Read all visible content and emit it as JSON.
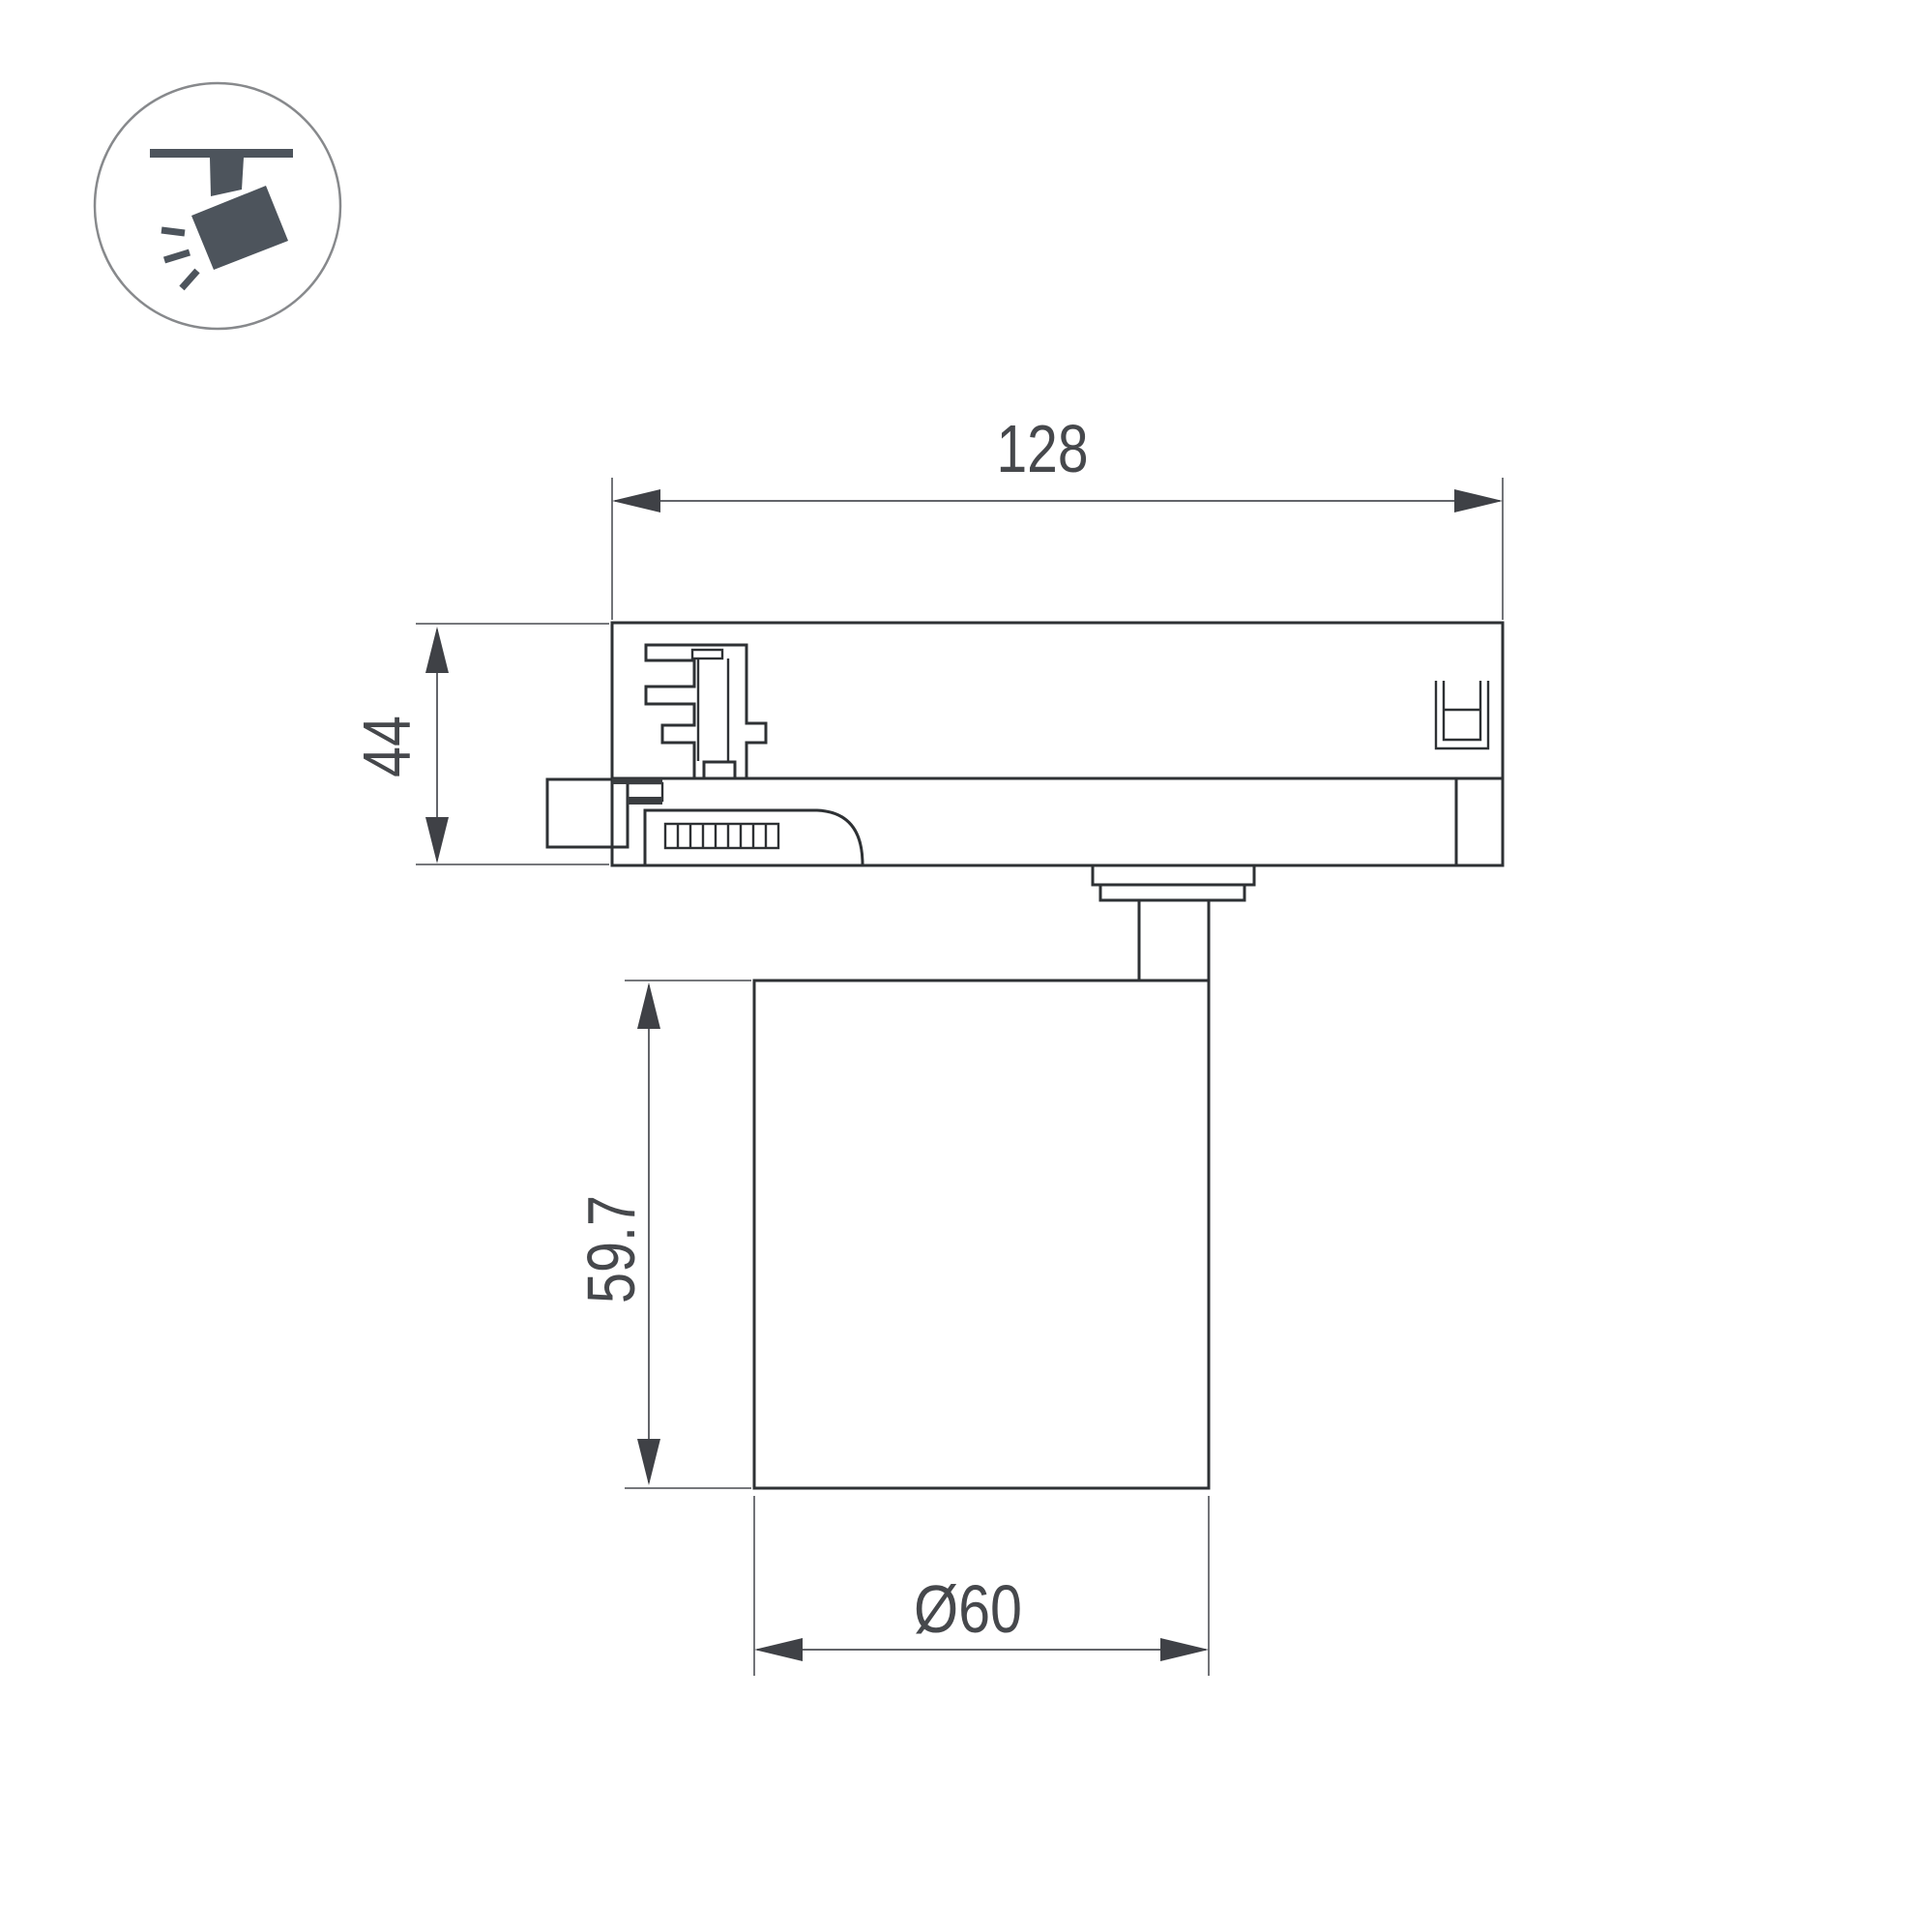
{
  "drawing": {
    "title": "Track spotlight dimensional drawing",
    "icon": "ceiling-track-spotlight-icon"
  },
  "dims": {
    "top_width": {
      "label": "128",
      "value": 128
    },
    "adapter_height": {
      "label": "44",
      "value": 44
    },
    "body_height": {
      "label": "59.7",
      "value": 59.7
    },
    "body_diameter": {
      "label": "Ø60",
      "value": 60
    }
  },
  "colors": {
    "outline": "#2e3134",
    "detail": "#3a3d40",
    "dimension_line": "#63656a",
    "dimension_text": "#46484c",
    "arrow": "#3f4146",
    "icon": "#4d545c",
    "icon_circle": "#87898c",
    "background": "#ffffff"
  }
}
